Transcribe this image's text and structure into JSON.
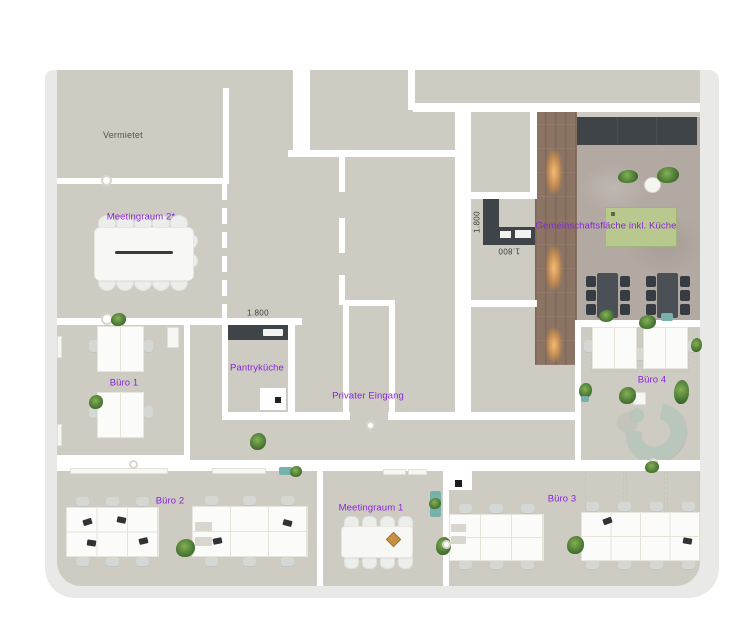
{
  "plan": {
    "rooms": {
      "vermietet": {
        "label": "Vermietet"
      },
      "meetingraum2": {
        "label": "Meetingraum 2*"
      },
      "buero1": {
        "label": "Büro 1"
      },
      "pantrykueche": {
        "label": "Pantryküche"
      },
      "privater_eingang": {
        "label": "Privater Eingang"
      },
      "gemeinschaftsflaeche": {
        "label": "Gemeinschaftsfläche inkl. Küche"
      },
      "buero4": {
        "label": "Büro 4"
      },
      "buero2": {
        "label": "Büro 2"
      },
      "meetingraum1": {
        "label": "Meetingraum 1"
      },
      "buero3": {
        "label": "Büro 3"
      }
    },
    "dimensions": {
      "pantry_counter": "1.800",
      "kitchen_vertical": "1.800",
      "kitchen_flipped": "1.800"
    },
    "colors": {
      "label_accent": "#8826d9",
      "floor": "#cecbc2",
      "wall": "#ffffff",
      "rim": "#e9eae8",
      "counter_dark": "#3f4449",
      "wood_floor": "#8c7464",
      "concrete": "#b2a9a2",
      "kitchen_mat_green": "#b9c88f",
      "sofa_green": "#b9c6bc",
      "light_glow": "#f0a95c"
    }
  }
}
